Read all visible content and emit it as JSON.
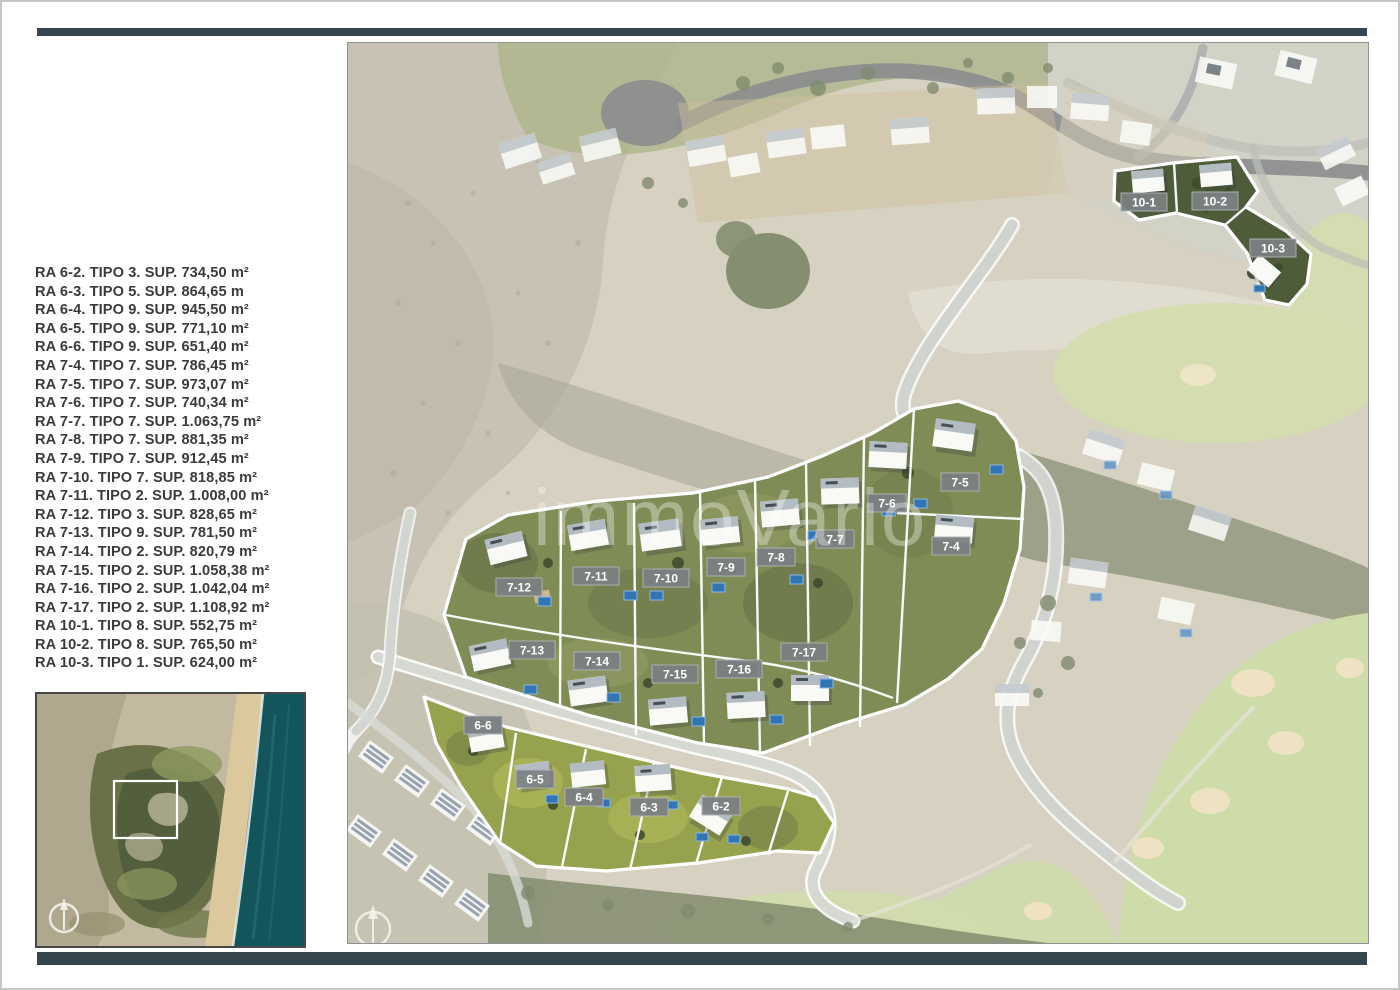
{
  "page": {
    "background": "#ffffff",
    "accent_bar_color": "#36464e",
    "border_color": "#c6c6c6"
  },
  "plot_list": {
    "items": [
      "RA 6-2. TIPO 3. SUP. 734,50 m²",
      "RA 6-3. TIPO 5. SUP. 864,65 m",
      "RA 6-4. TIPO 9. SUP. 945,50 m²",
      "RA 6-5. TIPO 9. SUP. 771,10 m²",
      "RA 6-6. TIPO 9. SUP. 651,40 m²",
      "RA 7-4. TIPO 7. SUP. 786,45 m²",
      "RA 7-5. TIPO 7. SUP. 973,07 m²",
      "RA 7-6. TIPO 7. SUP. 740,34 m²",
      "RA 7-7. TIPO 7. SUP. 1.063,75 m²",
      "RA 7-8. TIPO 7. SUP. 881,35 m²",
      "RA 7-9. TIPO 7. SUP. 912,45 m²",
      "RA 7-10. TIPO 7. SUP. 818,85 m²",
      "RA 7-11. TIPO 2. SUP. 1.008,00 m²",
      "RA 7-12. TIPO 3. SUP. 828,65 m²",
      "RA 7-13. TIPO 9. SUP. 781,50 m²",
      "RA 7-14. TIPO 2. SUP. 820,79 m²",
      "RA 7-15. TIPO 2. SUP. 1.058,38 m²",
      "RA 7-16. TIPO 2. SUP. 1.042,04 m²",
      "RA 7-17. TIPO 2. SUP. 1.108,92 m²",
      "RA 10-1. TIPO 8. SUP. 552,75 m²",
      "RA 10-2. TIPO 8. SUP. 765,50 m²",
      "RA 10-3. TIPO 1. SUP. 624,00 m²"
    ]
  },
  "map": {
    "watermark": "immoVario",
    "plot_labels": [
      {
        "text": "10-1",
        "x": 796,
        "y": 159
      },
      {
        "text": "10-2",
        "x": 867,
        "y": 158
      },
      {
        "text": "10-3",
        "x": 925,
        "y": 205
      },
      {
        "text": "7-5",
        "x": 612,
        "y": 439
      },
      {
        "text": "7-6",
        "x": 539,
        "y": 460
      },
      {
        "text": "7-7",
        "x": 487,
        "y": 496
      },
      {
        "text": "7-8",
        "x": 428,
        "y": 514
      },
      {
        "text": "7-9",
        "x": 378,
        "y": 524
      },
      {
        "text": "7-10",
        "x": 318,
        "y": 535
      },
      {
        "text": "7-11",
        "x": 248,
        "y": 533
      },
      {
        "text": "7-12",
        "x": 171,
        "y": 544
      },
      {
        "text": "7-4",
        "x": 603,
        "y": 503
      },
      {
        "text": "7-13",
        "x": 184,
        "y": 607
      },
      {
        "text": "7-14",
        "x": 249,
        "y": 618
      },
      {
        "text": "7-15",
        "x": 327,
        "y": 631
      },
      {
        "text": "7-16",
        "x": 391,
        "y": 626
      },
      {
        "text": "7-17",
        "x": 456,
        "y": 609
      },
      {
        "text": "6-6",
        "x": 135,
        "y": 682
      },
      {
        "text": "6-5",
        "x": 187,
        "y": 736
      },
      {
        "text": "6-4",
        "x": 236,
        "y": 754
      },
      {
        "text": "6-3",
        "x": 301,
        "y": 764
      },
      {
        "text": "6-2",
        "x": 373,
        "y": 763
      }
    ],
    "colors": {
      "plot_boundary": "#ffffff",
      "label_chip": "#7b8082",
      "pool": "#3175b5",
      "cluster_green": "#808c56",
      "bright_grass": "#97a24e",
      "fairway": "#c7d397",
      "bunker": "#e9dcb4",
      "dark_road": "#66696a",
      "light_road": "#c2c6bf"
    }
  },
  "inset": {
    "ocean_color": "#14555c",
    "beach_color": "#dbc89c",
    "location_marker": "white-rectangle"
  },
  "icons": {
    "compass": "compass-icon"
  }
}
